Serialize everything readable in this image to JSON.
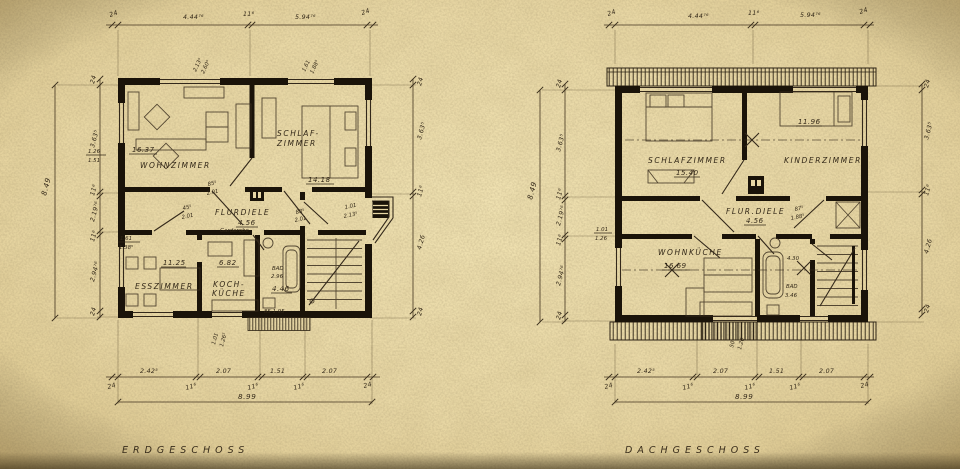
{
  "titles": {
    "left": "ERDGESCHOSS",
    "right": "DACHGESCHOSS"
  },
  "colors": {
    "paper": "#e8d7a4",
    "paper_light": "#f0e2b2",
    "paper_dark": "#d9c389",
    "ink": "#33281a",
    "wall": "#1a1309"
  },
  "dims": {
    "d24": "24",
    "d444": "4.44⁷⁶",
    "d116": "11⁶",
    "d594": "5.94⁷⁶",
    "d2425": "2.42⁵",
    "d207": "2.07",
    "d151": "1.51",
    "d899": "8.99",
    "d3635": "3.63⁵",
    "d21976": "2.19⁷⁶",
    "d29476": "2.94⁷⁶",
    "d849": "8.49",
    "d426": "4.26"
  },
  "eg": {
    "rooms": {
      "wohnzimmer": {
        "name": "WOHNZIMMER",
        "area": "16.37"
      },
      "schlafzimmer": {
        "name1": "SCHLAF-",
        "name2": "ZIMMER",
        "area": "14.18"
      },
      "flurdiele": {
        "name": "FLURDIELE",
        "area": "4.56",
        "note": "Garderobe"
      },
      "esszimmer": {
        "name": "ESSZIMMER",
        "area": "11.25"
      },
      "kochkueche": {
        "name1": "KOCH-",
        "name2": "KÜCHE",
        "area": "6.82"
      },
      "bad": {
        "name": "BAD",
        "l2": "2.96",
        "area": "4.46"
      }
    },
    "ann": {
      "win_top1a": "2.13⁵",
      "win_top1b": "2.60⁵",
      "win_top2a": "1.61",
      "win_top2b": "1.88⁵",
      "win_left1a": "1.26",
      "win_left1b": "1.51",
      "win_left2a": "1.61",
      "win_left2b": "1.38⁵",
      "door1a": "85⁵",
      "door1b": "2.01",
      "door2a": "45⁵",
      "door2b": "2.01",
      "door3a": "88⁵",
      "door3b": "2.01",
      "door4a": "1.01",
      "door4b": "2.13⁵",
      "entry": "85·1.95",
      "win_bot1a": "1.01",
      "win_bot1b": "1.26⁵"
    }
  },
  "dg": {
    "rooms": {
      "schlafzimmer": {
        "name": "SCHLAFZIMMER",
        "area": "15.40"
      },
      "kinderzimmer": {
        "name": "KINDERZIMMER",
        "area": "11.96"
      },
      "flurdiele": {
        "name": "FLUR.DIELE",
        "area": "4.56"
      },
      "wohnkueche": {
        "name": "WOHNKÜCHE",
        "area": "16.69"
      },
      "bad": {
        "name": "BAD",
        "area": "3.46",
        "note": "4.30"
      }
    },
    "ann": {
      "door1a": "87⁵",
      "door1b": "1.88⁵",
      "win_left1a": "1.01",
      "win_left1b": "1.26",
      "win_bot1a": "50",
      "win_bot1b": "1.26"
    }
  }
}
